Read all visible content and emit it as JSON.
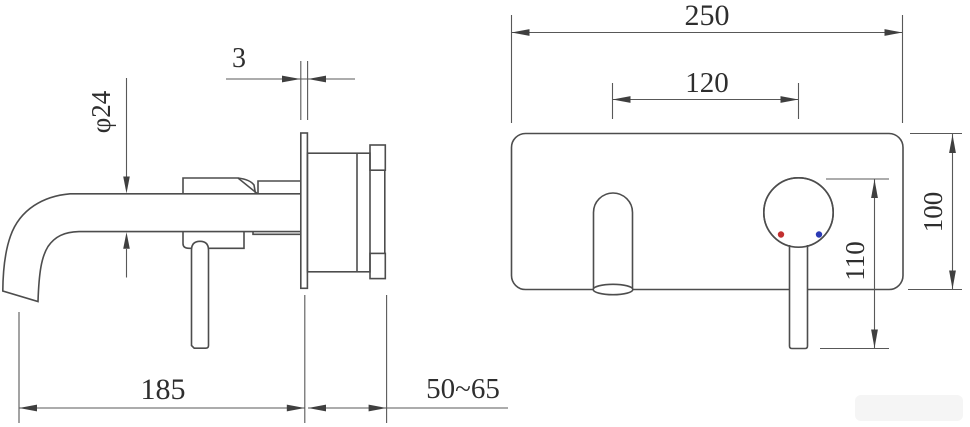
{
  "drawing": {
    "type": "technical-drawing",
    "subject": "wall-mounted basin mixer tap, side view and front view with dimensions"
  },
  "dimensions": {
    "spout_diameter": "φ24",
    "panel_thickness": "3",
    "spout_reach": "185",
    "concealed_depth": "50~65",
    "panel_width": "250",
    "spout_to_handle": "120",
    "handle_drop": "110",
    "panel_height": "100"
  },
  "colors": {
    "line": "#4d4d4d",
    "hot_indicator": "#c23030",
    "cold_indicator": "#2b3ab5",
    "background": "#ffffff"
  }
}
